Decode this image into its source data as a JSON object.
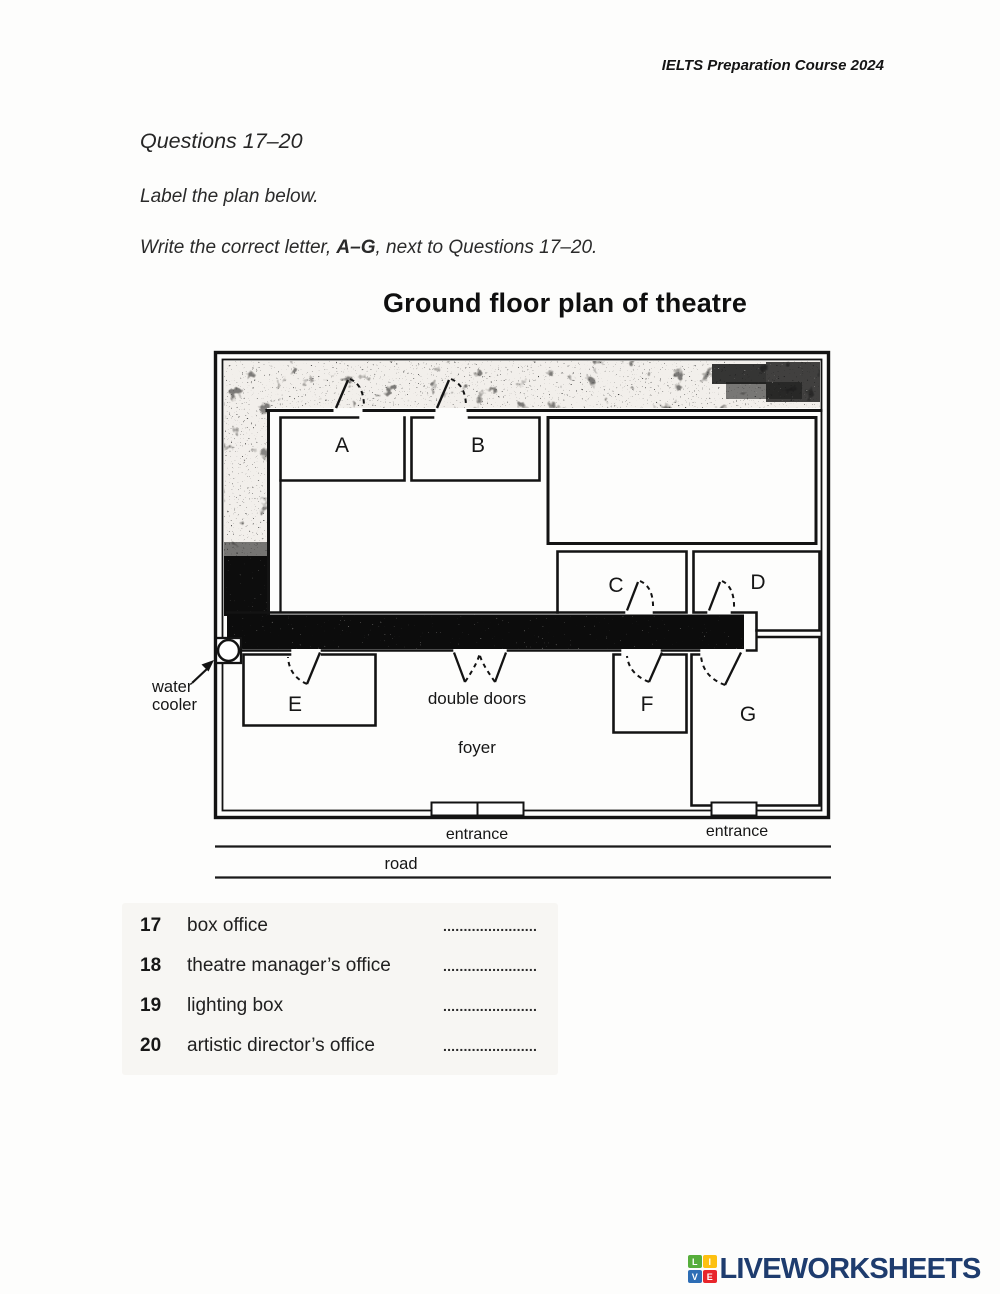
{
  "header": {
    "course": "IELTS Preparation Course 2024"
  },
  "instructions": {
    "range": "Questions 17–20",
    "line1": "Label the plan below.",
    "line2_prefix": "Write the correct letter, ",
    "line2_bold": "A–G",
    "line2_suffix": ", next to Questions 17–20."
  },
  "plan": {
    "title": "Ground floor plan of theatre",
    "rooms": [
      "A",
      "B",
      "C",
      "D",
      "E",
      "F",
      "G"
    ],
    "labels": {
      "water_cooler_line1": "water",
      "water_cooler_line2": "cooler",
      "double_doors": "double doors",
      "foyer": "foyer",
      "entrance_left": "entrance",
      "entrance_right": "entrance",
      "road": "road"
    }
  },
  "questions": [
    {
      "number": "17",
      "text": "box office",
      "blank": "......................."
    },
    {
      "number": "18",
      "text": "theatre manager’s office",
      "blank": "......................."
    },
    {
      "number": "19",
      "text": "lighting box",
      "blank": "......................."
    },
    {
      "number": "20",
      "text": "artistic director’s office",
      "blank": "......................."
    }
  ],
  "footer": {
    "brand": "LIVEWORKSHEETS",
    "brand_color": "#1e3c6e",
    "tiles": [
      {
        "letter": "L",
        "color": "#56ae3b"
      },
      {
        "letter": "I",
        "color": "#fdc010"
      },
      {
        "letter": "V",
        "color": "#2d6db5"
      },
      {
        "letter": "E",
        "color": "#e8252b"
      }
    ]
  }
}
